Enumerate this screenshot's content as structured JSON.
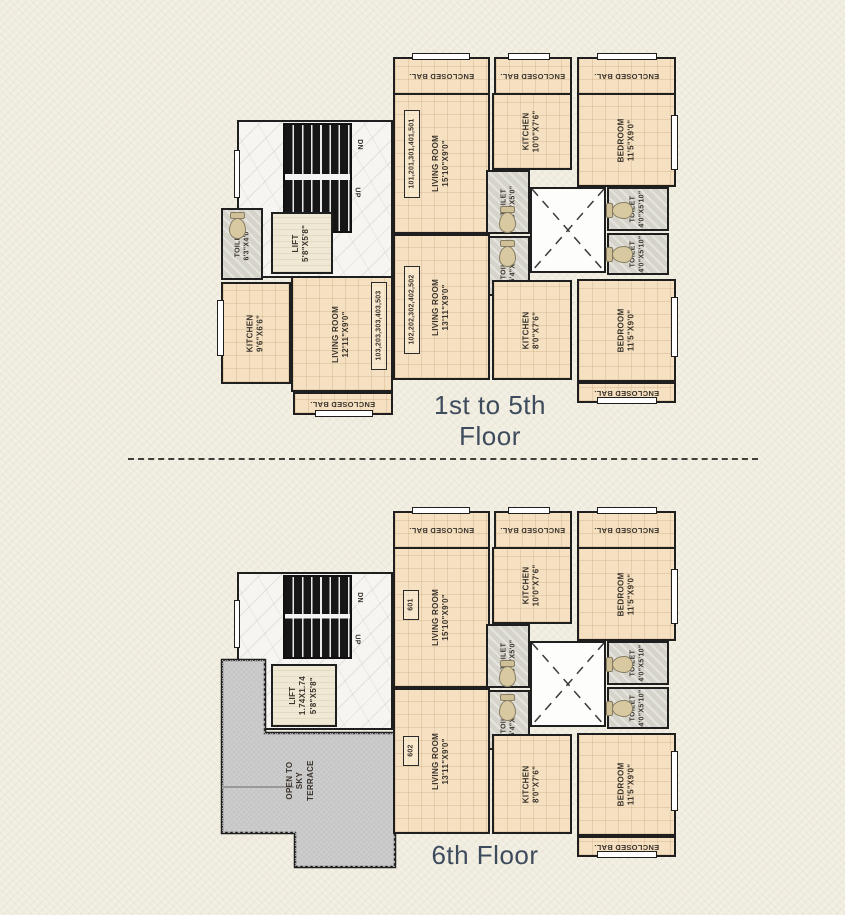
{
  "colors": {
    "background": "#f0ecdf",
    "room-fill": "#f5e1c2",
    "wet-fill": "#d6d3cb",
    "hall-fill": "#f6f5f1",
    "terrace-fill": "#cecece",
    "wall": "#1f1f1f",
    "caption": "#3d4b5c",
    "label": "#3a332b"
  },
  "captions": {
    "plan1": "1st to 5th Floor",
    "plan2": "6th Floor"
  },
  "stairs": {
    "dn": "DN",
    "up": "UP"
  },
  "units": {
    "u1": "101,201,301,401,501",
    "u2": "102,202,302,402,502",
    "u3": "103,203,303,403,503",
    "u601": "601",
    "u602": "602"
  },
  "rooms": {
    "enclosed_bal": "ENCLOSED BAL.",
    "living_a": "LIVING ROOM\n15'10\"X9'0\"",
    "kitchen_a": "KITCHEN\n10'0\"X7'6\"",
    "bedroom": "BEDROOM\n11'5\"X9'0\"",
    "toilet_54": "TOILET\n5'4\"X5'0\"",
    "toilet_40": "TOILET\n4'0\"X5'10\"",
    "living_b": "LIVING ROOM\n13'11\"X9'0\"",
    "kitchen_b": "KITCHEN\n8'0\"X7'6\"",
    "toilet_63": "TOILET\n6'3\"X4'0\"",
    "lift_a": "LIFT\n5'8\"X5'8\"",
    "kitchen_c": "KITCHEN\n9'6\"X6'6\"",
    "living_c": "LIVING ROOM\n12'11\"X9'0\"",
    "lift_b": "LIFT\n1.74X1.74\n5'8\"X5'8\"",
    "terrace": "OPEN TO SKY\nTERRACE"
  }
}
